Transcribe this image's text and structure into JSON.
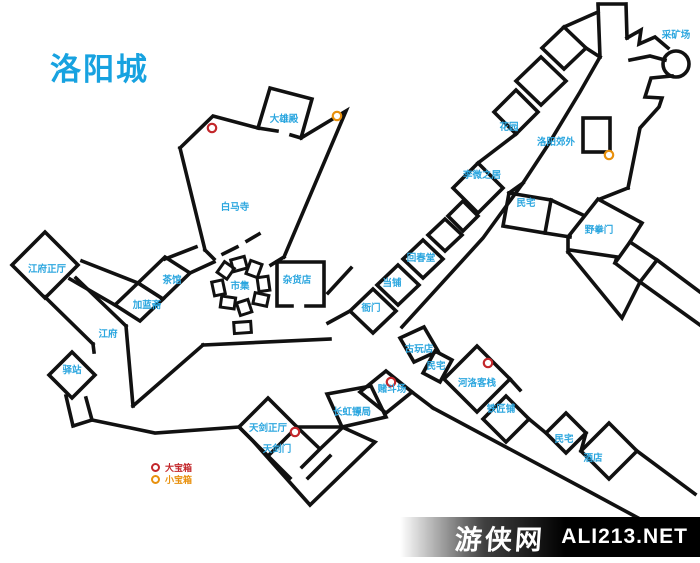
{
  "title": "洛阳城",
  "legend": {
    "big_chest_label": "大宝箱",
    "small_chest_label": "小宝箱"
  },
  "watermark": {
    "site_name": "游侠网",
    "site_domain": "ALI213.NET"
  },
  "colors": {
    "label_blue": "#2BA6DF",
    "title_blue": "#17A2E0",
    "wall": "#111111",
    "big_chest_red": "#C3272B",
    "small_chest_orange": "#E8900C"
  },
  "locations": [
    {
      "id": "daxiongdian",
      "name": "大雄殿",
      "x": 284,
      "y": 122
    },
    {
      "id": "baimasi",
      "name": "白马寺",
      "x": 235,
      "y": 210
    },
    {
      "id": "caikuangchang",
      "name": "采矿场",
      "x": 676,
      "y": 38
    },
    {
      "id": "huayuan",
      "name": "花园",
      "x": 509,
      "y": 130
    },
    {
      "id": "luoyang-jiaowai",
      "name": "洛阳郊外",
      "x": 556,
      "y": 145
    },
    {
      "id": "liwei-zhiju",
      "name": "李微之居",
      "x": 482,
      "y": 178
    },
    {
      "id": "minzhai-north",
      "name": "民宅",
      "x": 526,
      "y": 206
    },
    {
      "id": "yequanmen",
      "name": "野拳门",
      "x": 599,
      "y": 233
    },
    {
      "id": "huichuntang",
      "name": "回春堂",
      "x": 421,
      "y": 261
    },
    {
      "id": "dangpu",
      "name": "当铺",
      "x": 392,
      "y": 286
    },
    {
      "id": "zahuodian",
      "name": "杂货店",
      "x": 297,
      "y": 283
    },
    {
      "id": "shiji",
      "name": "市集",
      "x": 240,
      "y": 289
    },
    {
      "id": "chaguan",
      "name": "茶馆",
      "x": 172,
      "y": 283
    },
    {
      "id": "jialanzhai",
      "name": "加蓝斋",
      "x": 147,
      "y": 308
    },
    {
      "id": "jiangfu-zhengting",
      "name": "江府正厅",
      "x": 47,
      "y": 272
    },
    {
      "id": "jiangfu",
      "name": "江府",
      "x": 108,
      "y": 337
    },
    {
      "id": "yizhan",
      "name": "驿站",
      "x": 72,
      "y": 373
    },
    {
      "id": "yamen",
      "name": "衙门",
      "x": 371,
      "y": 311
    },
    {
      "id": "guwandian",
      "name": "古玩店",
      "x": 419,
      "y": 352
    },
    {
      "id": "minzhai-mid",
      "name": "民宅",
      "x": 436,
      "y": 369
    },
    {
      "id": "heluo-kezhan",
      "name": "河洛客栈",
      "x": 477,
      "y": 386
    },
    {
      "id": "tiejiangpu",
      "name": "铁匠铺",
      "x": 501,
      "y": 412
    },
    {
      "id": "minzhai-south",
      "name": "民宅",
      "x": 564,
      "y": 442
    },
    {
      "id": "jiudian",
      "name": "酒店",
      "x": 593,
      "y": 461
    },
    {
      "id": "dudouchang",
      "name": "赌斗场",
      "x": 392,
      "y": 392
    },
    {
      "id": "changhong-biaoju",
      "name": "长虹镖局",
      "x": 352,
      "y": 415
    },
    {
      "id": "tianjian-zhengting",
      "name": "天剑正厅",
      "x": 268,
      "y": 431
    },
    {
      "id": "tianjianmen",
      "name": "天剑门",
      "x": 277,
      "y": 452
    }
  ],
  "treasures": {
    "big": [
      {
        "x": 212,
        "y": 128
      },
      {
        "x": 295,
        "y": 432
      },
      {
        "x": 391,
        "y": 382
      },
      {
        "x": 488,
        "y": 363
      }
    ],
    "small": [
      {
        "x": 337,
        "y": 116
      },
      {
        "x": 609,
        "y": 155
      }
    ]
  }
}
